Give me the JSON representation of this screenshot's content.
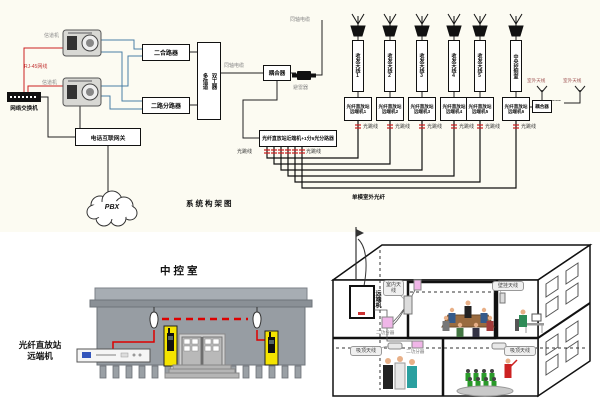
{
  "top_diagram": {
    "title": "系统构架图",
    "channel_unit_label": "信道机",
    "switch_label": "网络交换机",
    "rj45_label": "RJ-45网线",
    "combiner_label": "二合路器",
    "splitter_label": "二路分路器",
    "duplexer_label_col1": "多信道",
    "duplexer_label_col2": "双工器",
    "coax_cable_label": "同轴电缆",
    "coupler_label": "耦合器",
    "arrester_label": "避雷器",
    "gateway_label": "电话互联网关",
    "pbx_label": "PBX",
    "near_end_label": "光纤直放站近端机+1分6光分路器",
    "fiber_jumper_label": "光跳线",
    "outdoor_fiber_label": "单模室外光纤",
    "outdoor_antenna_label": "室外天线",
    "coupler2_label": "耦合器",
    "dots": "……",
    "antenna_units": [
      "收发天线1",
      "收发天线2",
      "收发天线3",
      "收发天线4",
      "收发天线5",
      "中央控制室"
    ],
    "remote_units": [
      "光纤直放站远端机1",
      "光纤直放站远端机2",
      "光纤直放站远端机3",
      "光纤直放站远端机4",
      "光纤直放站远端机5",
      "光纤直放站远端机6"
    ]
  },
  "control_room": {
    "title": "中控室",
    "device_label_line1": "光纤直放站",
    "device_label_line2": "远端机"
  },
  "building_view": {
    "remote_unit_label": "远端机",
    "indoor_antenna_callout": "室内天线",
    "wall_antenna_callout": "壁挂天线",
    "ceiling_antenna_callout": "吸顶天线",
    "splitter_label": "二功分器"
  },
  "colors": {
    "accent_red": "#cc2222",
    "line_blue": "#4a7fa5",
    "holder_yellow": "#f5e400",
    "splitter_pink": "#f0b6e8"
  }
}
